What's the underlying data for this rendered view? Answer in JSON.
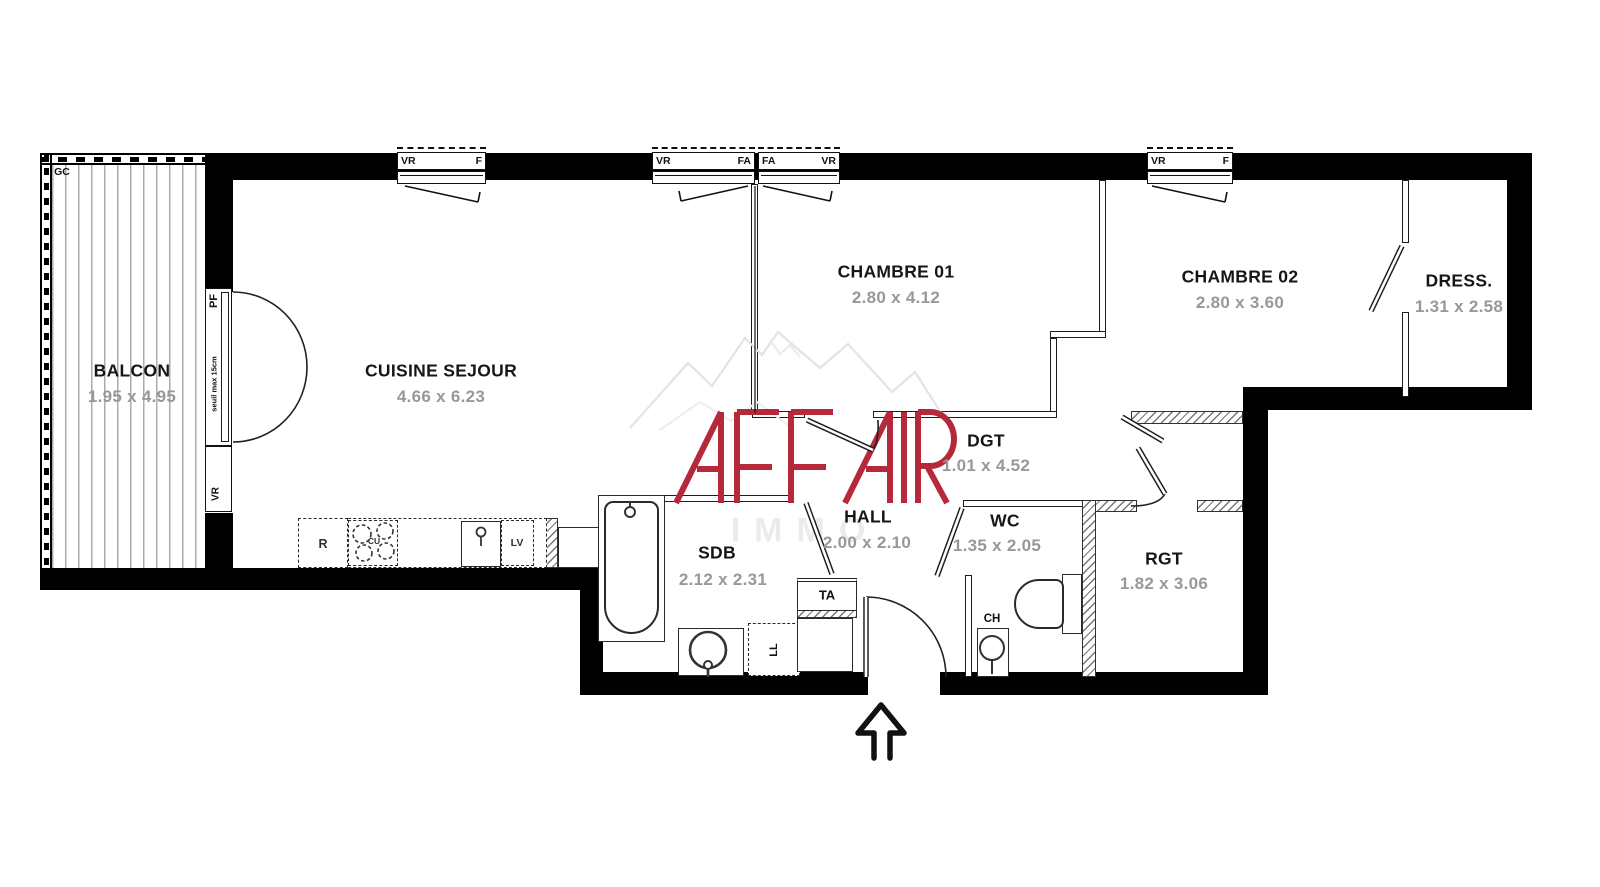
{
  "rooms": [
    {
      "name": "BALCON",
      "dims": "1.95 x 4.95"
    },
    {
      "name": "CUISINE SEJOUR",
      "dims": "4.66 x 6.23"
    },
    {
      "name": "CHAMBRE 01",
      "dims": "2.80 x 4.12"
    },
    {
      "name": "CHAMBRE 02",
      "dims": "2.80 x 3.60"
    },
    {
      "name": "DRESS.",
      "dims": "1.31 x 2.58"
    },
    {
      "name": "DGT",
      "dims": "1.01 x 4.52"
    },
    {
      "name": "HALL",
      "dims": "2.00 x 2.10"
    },
    {
      "name": "WC",
      "dims": "1.35 x 2.05"
    },
    {
      "name": "SDB",
      "dims": "2.12 x 2.31"
    },
    {
      "name": "RGT",
      "dims": "1.82 x 3.06"
    }
  ],
  "windows": [
    {
      "left": "VR",
      "right": "F"
    },
    {
      "left": "VR",
      "right": "FA"
    },
    {
      "left": "FA",
      "right": "VR"
    },
    {
      "left": "VR",
      "right": "F"
    }
  ],
  "annotations": {
    "gc": "GC",
    "pf": "PF",
    "vr": "VR",
    "seuil": "seuil max 15cm",
    "ta": "TA",
    "ch": "CH",
    "ll": "LL",
    "r": "R",
    "cu": "CU",
    "lv": "LV"
  },
  "watermark": {
    "brand": "AFFAIR",
    "sub": "IMMO",
    "accent": "#b5293b"
  }
}
